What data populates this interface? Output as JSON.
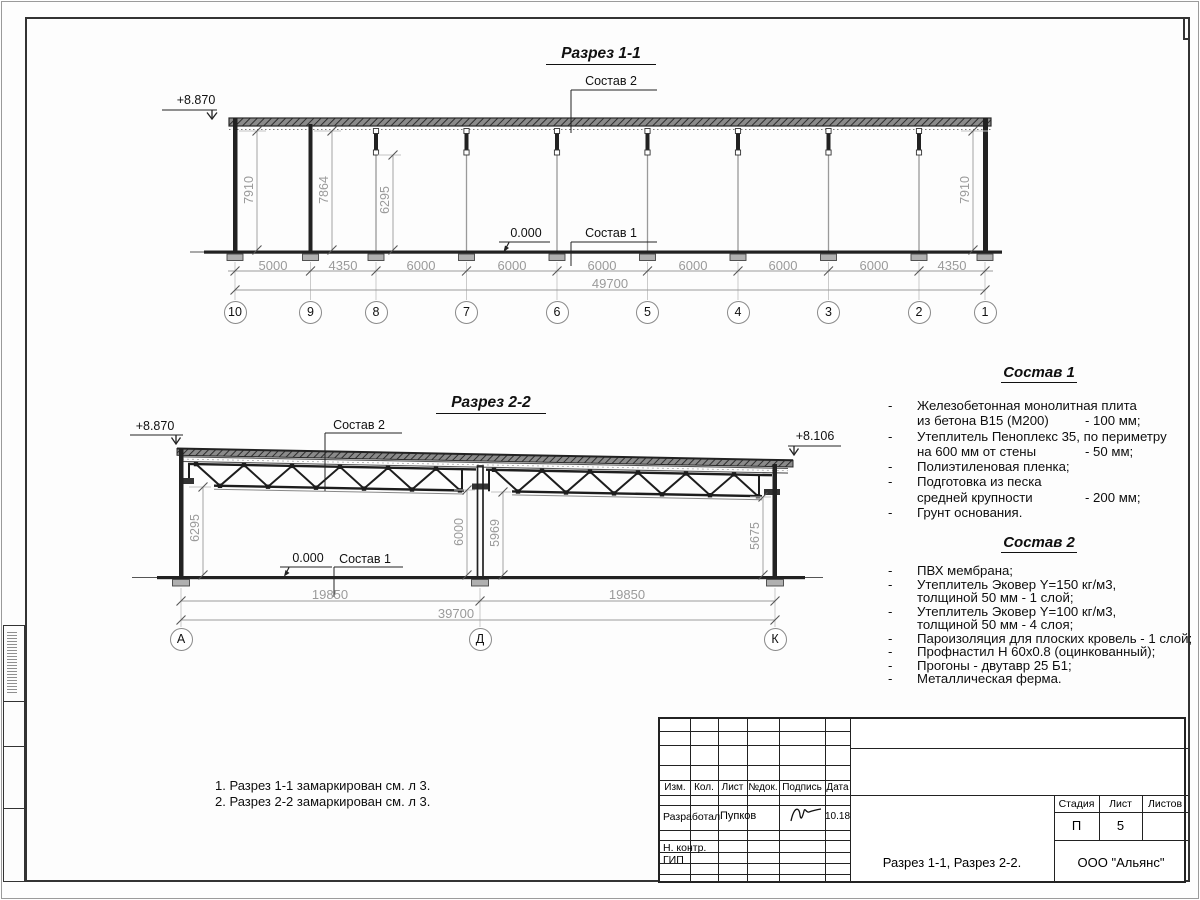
{
  "s1": {
    "title": "Разрез 1-1",
    "level_top": "+8.870",
    "level_zero": "0.000",
    "sostav1": "Состав 1",
    "sostav2": "Состав 2",
    "heights": [
      "7910",
      "7864",
      "6295",
      "7910"
    ],
    "bays": [
      "5000",
      "4350",
      "6000",
      "6000",
      "6000",
      "6000",
      "6000",
      "6000",
      "4350"
    ],
    "total": "49700",
    "axes": [
      "10",
      "9",
      "8",
      "7",
      "6",
      "5",
      "4",
      "3",
      "2",
      "1"
    ]
  },
  "s2": {
    "title": "Разрез 2-2",
    "level_left": "+8.870",
    "level_right": "+8.106",
    "level_zero": "0.000",
    "sostav1": "Состав 1",
    "sostav2": "Состав 2",
    "heights": [
      "6295",
      "6000",
      "5969",
      "5675"
    ],
    "spans": [
      "19850",
      "19850"
    ],
    "total": "39700",
    "axes": [
      "А",
      "Д",
      "К"
    ]
  },
  "specs1": {
    "title": "Состав 1",
    "lines": [
      {
        "d": "-",
        "t": "Железобетонная  монолитная плита",
        "v": ""
      },
      {
        "d": "",
        "t": "из бетона В15 (М200)",
        "v": "- 100 мм;"
      },
      {
        "d": "-",
        "t": "Утеплитель Пеноплекс 35, по периметру",
        "v": ""
      },
      {
        "d": "",
        "t": "на 600 мм от стены",
        "v": "- 50 мм;"
      },
      {
        "d": "-",
        "t": "Полиэтиленовая пленка;",
        "v": ""
      },
      {
        "d": "-",
        "t": "Подготовка из песка",
        "v": ""
      },
      {
        "d": "",
        "t": "средней крупности",
        "v": "- 200 мм;"
      },
      {
        "d": "-",
        "t": "Грунт основания.",
        "v": ""
      }
    ]
  },
  "specs2": {
    "title": "Состав 2",
    "lines": [
      {
        "d": "-",
        "t": "ПВХ мембрана;",
        "v": ""
      },
      {
        "d": "-",
        "t": "Утеплитель Эковер Y=150 кг/м3,",
        "v": ""
      },
      {
        "d": "",
        "t": "толщиной 50 мм - 1 слой;",
        "v": ""
      },
      {
        "d": "-",
        "t": "Утеплитель Эковер Y=100 кг/м3,",
        "v": ""
      },
      {
        "d": "",
        "t": "толщиной 50 мм - 4 слоя;",
        "v": ""
      },
      {
        "d": "-",
        "t": "Пароизоляция для плоских кровель - 1 слой;",
        "v": ""
      },
      {
        "d": "-",
        "t": "Профнастил Н 60х0.8 (оцинкованный);",
        "v": ""
      },
      {
        "d": "-",
        "t": "Прогоны - двутавр 25 Б1;",
        "v": ""
      },
      {
        "d": "-",
        "t": "Металлическая ферма.",
        "v": ""
      }
    ]
  },
  "notes": {
    "n1": "1. Разрез 1-1 замаркирован см. л 3.",
    "n2": "2. Разрез 2-2 замаркирован см. л 3."
  },
  "tb": {
    "h_izm": "Изм.",
    "h_kol": "Кол.",
    "h_list": "Лист",
    "h_ndok": "№док.",
    "h_podpis": "Подпись",
    "h_data": "Дата",
    "developed_label": "Разработал",
    "developed_name": "Пупков",
    "developed_date": "10.18",
    "ncontr_label": "Н. контр.",
    "gip_label": "ГИП",
    "h_stage": "Стадия",
    "h_sheet": "Лист",
    "h_sheets": "Листов",
    "stage_value": "П",
    "sheet_value": "5",
    "sheets_value": "",
    "doc_title": "Разрез 1-1, Разрез 2-2.",
    "company": "ООО \"Альянс\""
  },
  "colors": {
    "ink": "#222222",
    "dim_text": "#9a9a9a",
    "fill_concrete": "#b0b0b0"
  }
}
